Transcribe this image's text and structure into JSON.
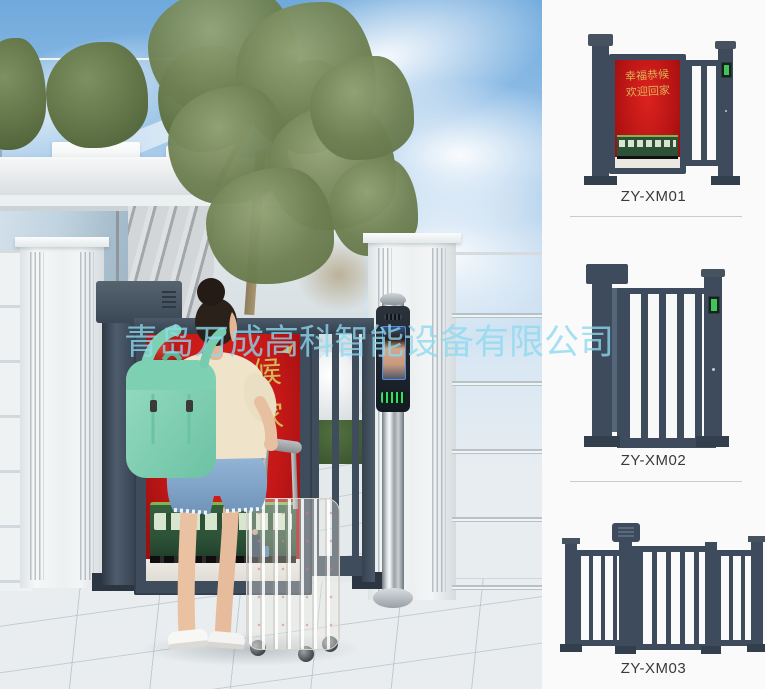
{
  "watermark": {
    "text": "青岛万成高科智能设备有限公司"
  },
  "scene": {
    "poster": {
      "line1": "幸福恭候",
      "line2": "欢迎回家"
    }
  },
  "products": [
    {
      "label": "ZY-XM01",
      "poster": {
        "line1": "幸福恭候",
        "line2": "欢迎回家"
      }
    },
    {
      "label": "ZY-XM02"
    },
    {
      "label": "ZY-XM03"
    }
  ],
  "colors": {
    "gate_metal": "#3e4b5c",
    "poster_red": "#c41717",
    "poster_gold": "#ddb258",
    "train_green": "#2c5137",
    "watermark_cyan": "#8dd8f0",
    "backpack_mint": "#8fd7bd",
    "sky_blue": "#79aede",
    "divider_gray": "#cbcbcb",
    "label_text": "#3a3a3a"
  }
}
